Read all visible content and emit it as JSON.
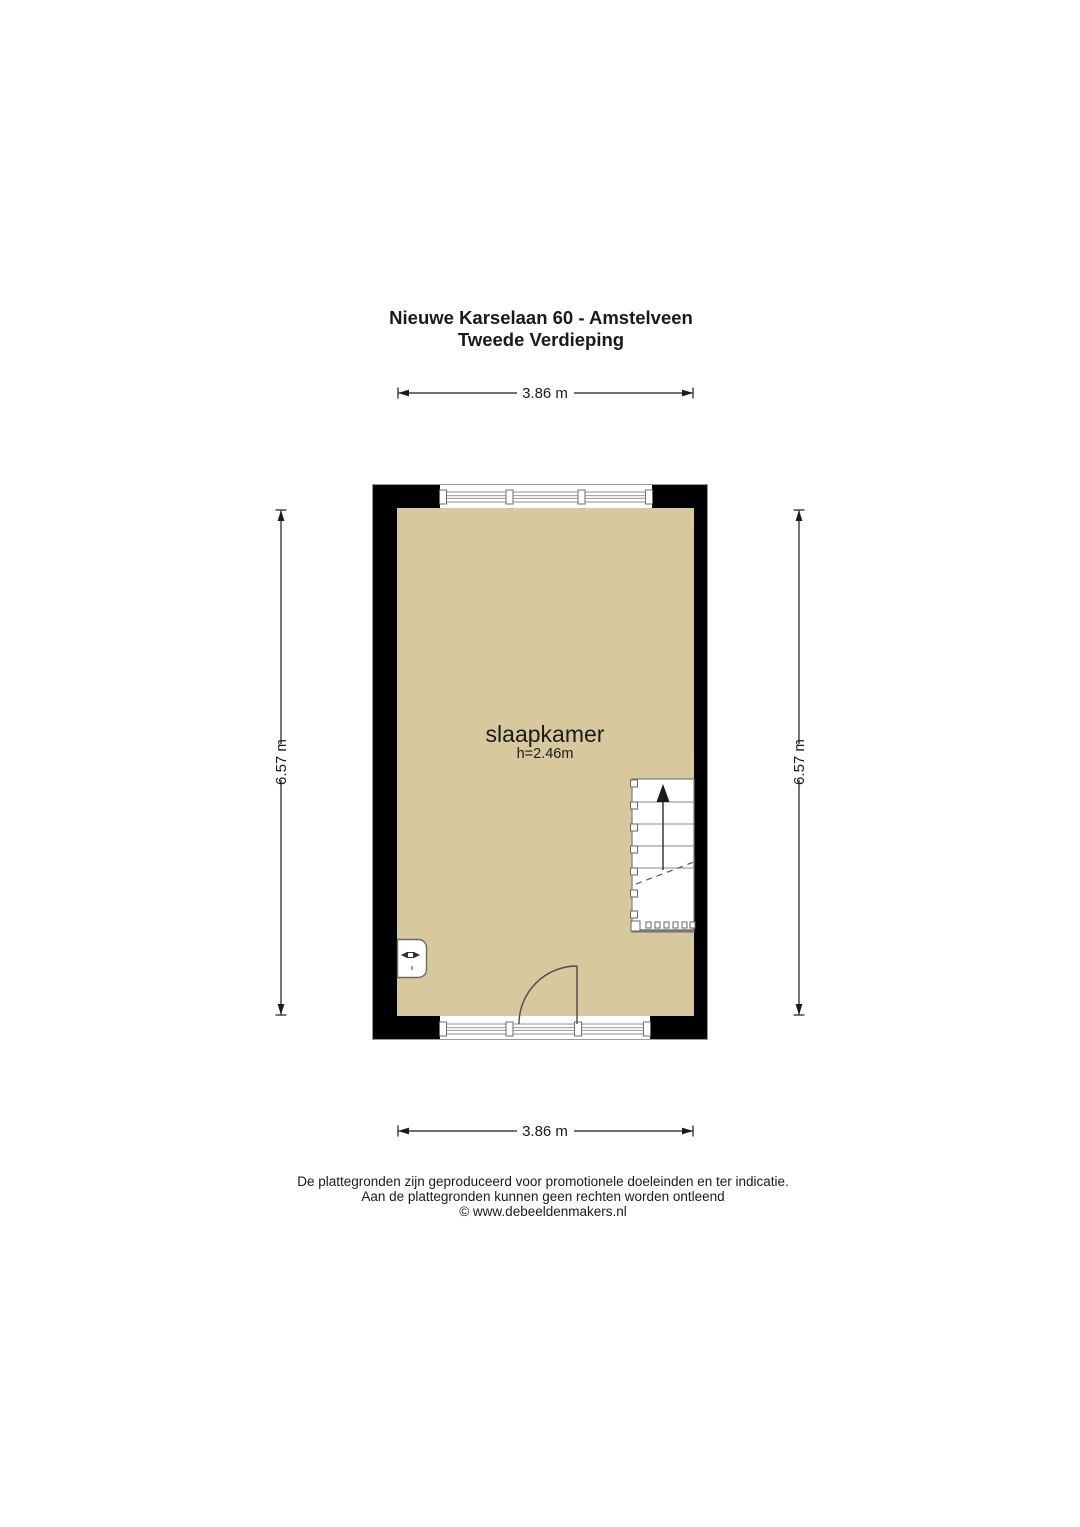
{
  "title": {
    "line1": "Nieuwe Karselaan 60 - Amstelveen",
    "line2": "Tweede Verdieping"
  },
  "dimensions": {
    "width_top": "3.86 m",
    "width_bottom": "3.86 m",
    "height_left": "6.57 m",
    "height_right": "6.57 m"
  },
  "room": {
    "name": "slaapkamer",
    "ceiling_height": "h=2.46m"
  },
  "symbols": {
    "stairs": "stairs-up-arrow",
    "door": "door-swing-arc",
    "radiator": "radiator-valve",
    "windows": "double-line-window"
  },
  "footer": {
    "line1": "De plattegronden zijn geproduceerd voor promotionele doeleinden en ter indicatie.",
    "line2": "Aan de plattegronden kunnen geen rechten worden ontleend",
    "line3": "© www.debeeldenmakers.nl"
  },
  "colors": {
    "background": "#ffffff",
    "floor": "#d8c89e",
    "wall": "#000000",
    "window_line": "#8c8c8c",
    "stair_line": "#8a8a8a",
    "door_line": "#4a4a4a",
    "text": "#1a1a1a"
  }
}
